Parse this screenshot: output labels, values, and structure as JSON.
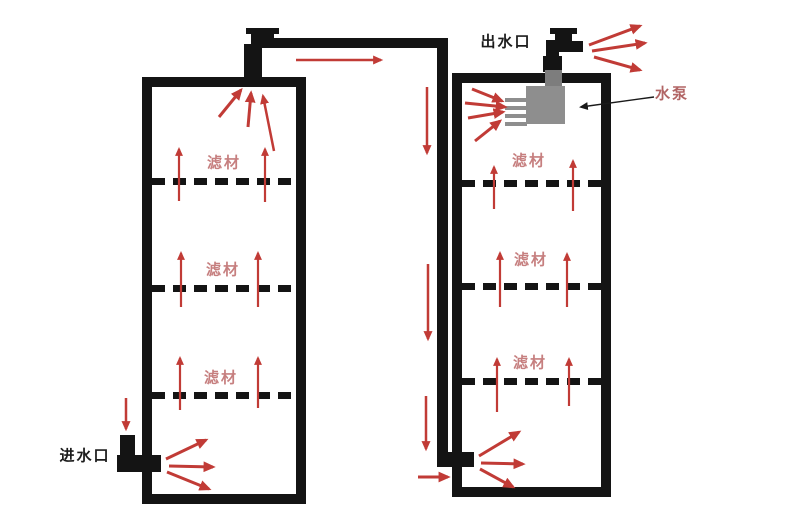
{
  "diagram": {
    "labels": {
      "inlet": "进水口",
      "outlet": "出水口",
      "pump": "水泵",
      "filter_media": "滤材"
    },
    "tanks": [
      {
        "id": "left-filter-tank",
        "sections": [
          "滤材",
          "滤材",
          "滤材"
        ]
      },
      {
        "id": "right-filter-tank",
        "sections": [
          "滤材",
          "滤材",
          "滤材"
        ]
      }
    ],
    "colors": {
      "flow_arrow_red": "#c13b36",
      "media_label_pink": "#c67f7f",
      "pump_label_pink": "#b26565",
      "pipe_black": "#141414",
      "pump_gray": "#8e8e8e",
      "background": "#ffffff"
    }
  }
}
